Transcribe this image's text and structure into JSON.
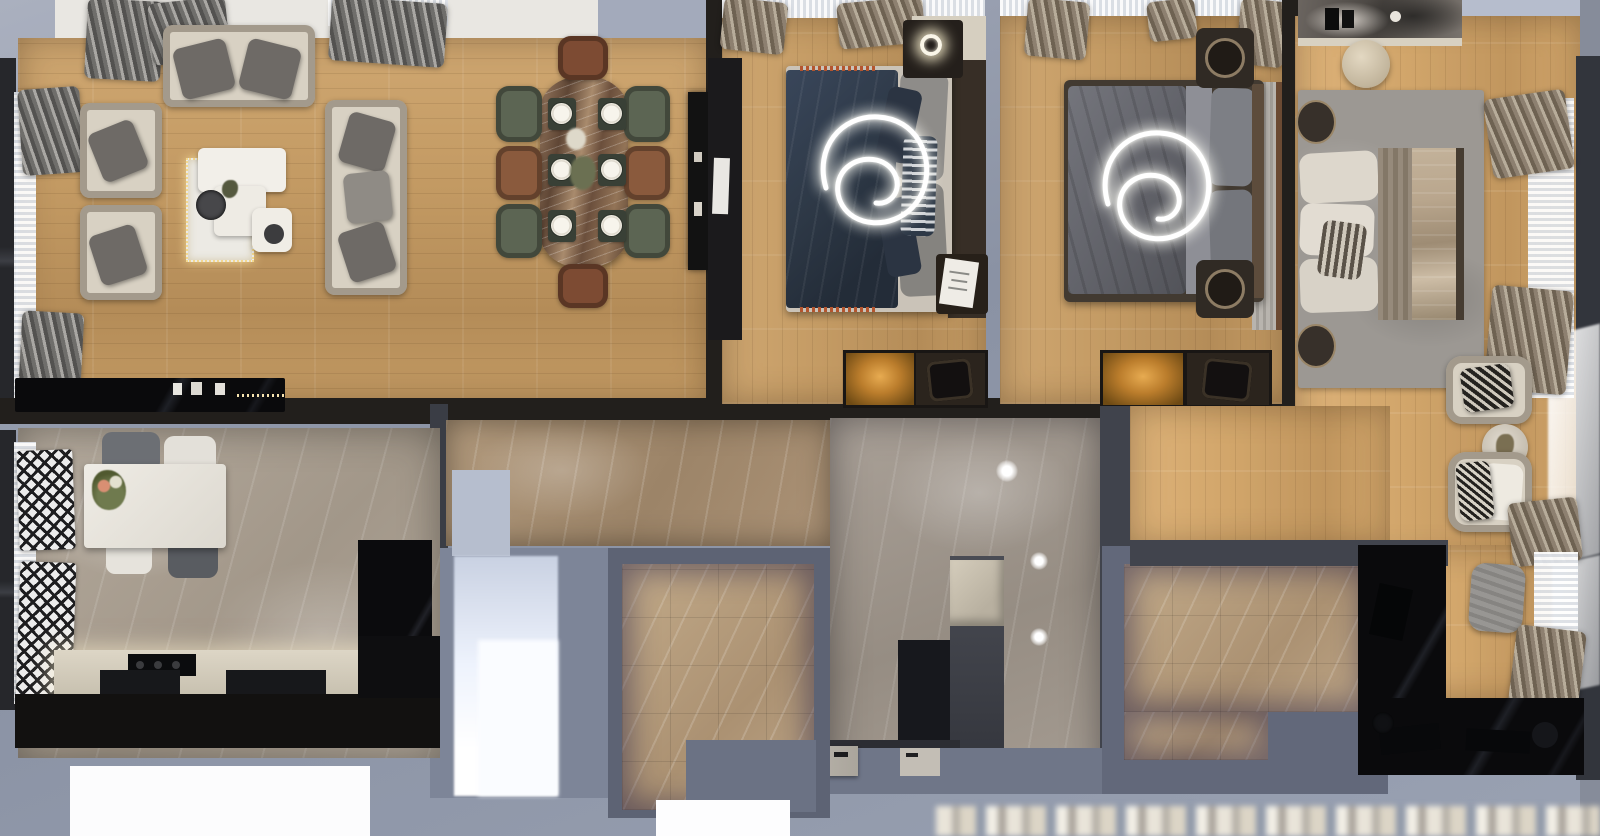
{
  "scene": {
    "label": "Top-down 3D render of a furnished apartment floor plan",
    "style": "photorealistic dollhouse cutaway, no visible text"
  },
  "palette": {
    "exterior": "#8f97a9",
    "exterior_light": "#b6bdcd",
    "wall_dark": "#221f1c",
    "wood": "#c39a63",
    "wood_light": "#cfa771",
    "marble_gray": "#b5ab9e",
    "marble_tan": "#b29a7d",
    "marble_beige": "#c2aa89",
    "cream": "#dbd2c1",
    "sofa_cream": "#d8d1c3",
    "cushion_gray": "#6e6a66",
    "bed_navy": "#2e3947",
    "bed_gray": "#63646b",
    "duvet_champagne": "#b9a68d",
    "rug_gray": "#9c9893",
    "amber_glow": "#bb7d2c",
    "desk_black": "#0a0a0c"
  },
  "rooms": {
    "living_room": {
      "label": "Living room",
      "furniture": "three-seat sofa, two armchairs, side sofa, marble coffee tables, rug with string lights, TV sideboard"
    },
    "dining_area": {
      "label": "Dining area",
      "furniture": "marble dining table, 8 chairs, 6 place settings, black sideboard"
    },
    "bedroom_1": {
      "label": "Bedroom 1",
      "furniture": "double bed with navy bedding, spiral ceiling lamp, nightstand with ring lamp, lit wardrobe"
    },
    "bedroom_2": {
      "label": "Bedroom 2",
      "furniture": "double bed with gray bedding, spiral ceiling lamp, two round nightstands, lit wardrobe"
    },
    "master_bedroom": {
      "label": "Master bedroom",
      "furniture": "double bed on gray rug, marble vanity, stool, round nightstands, two armchairs, plant side table"
    },
    "kitchen": {
      "label": "Kitchen",
      "furniture": "white table, four chairs, lit counter with cooktop, tall black cabinet"
    },
    "hallway": {
      "label": "Hallway",
      "furniture": "tan marble floor"
    },
    "entry_hall": {
      "label": "Entry hall",
      "furniture": "gray marble floor, three ceiling lights, storage cabinet, entry doors"
    },
    "bathroom_1": {
      "label": "Bathroom 1",
      "furniture": "beige marble tile floor"
    },
    "bathroom_2": {
      "label": "Bathroom 2",
      "furniture": "beige marble tile floor"
    },
    "home_office": {
      "label": "Home office corner",
      "furniture": "black L-shaped desk, gray pouf, curtained window"
    },
    "balcony": {
      "label": "Balcony / exterior edge"
    }
  }
}
